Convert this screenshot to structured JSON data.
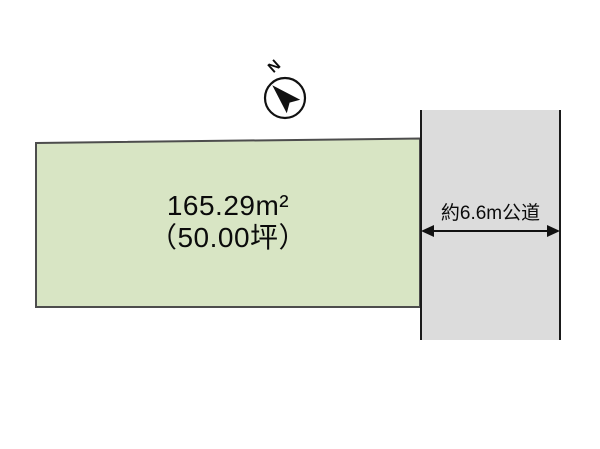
{
  "page": {
    "background": "#ffffff",
    "text_color": "#0b0b0b"
  },
  "compass": {
    "label": "N"
  },
  "parcel": {
    "area_label": "165.29m²",
    "tsubo_label": "（50.00坪）",
    "fill": "#d8e5c4",
    "border": "#4d4d4d"
  },
  "road": {
    "label": "約6.6m公道",
    "fill": "#dcdcdc",
    "border": "#1a1a1a"
  }
}
